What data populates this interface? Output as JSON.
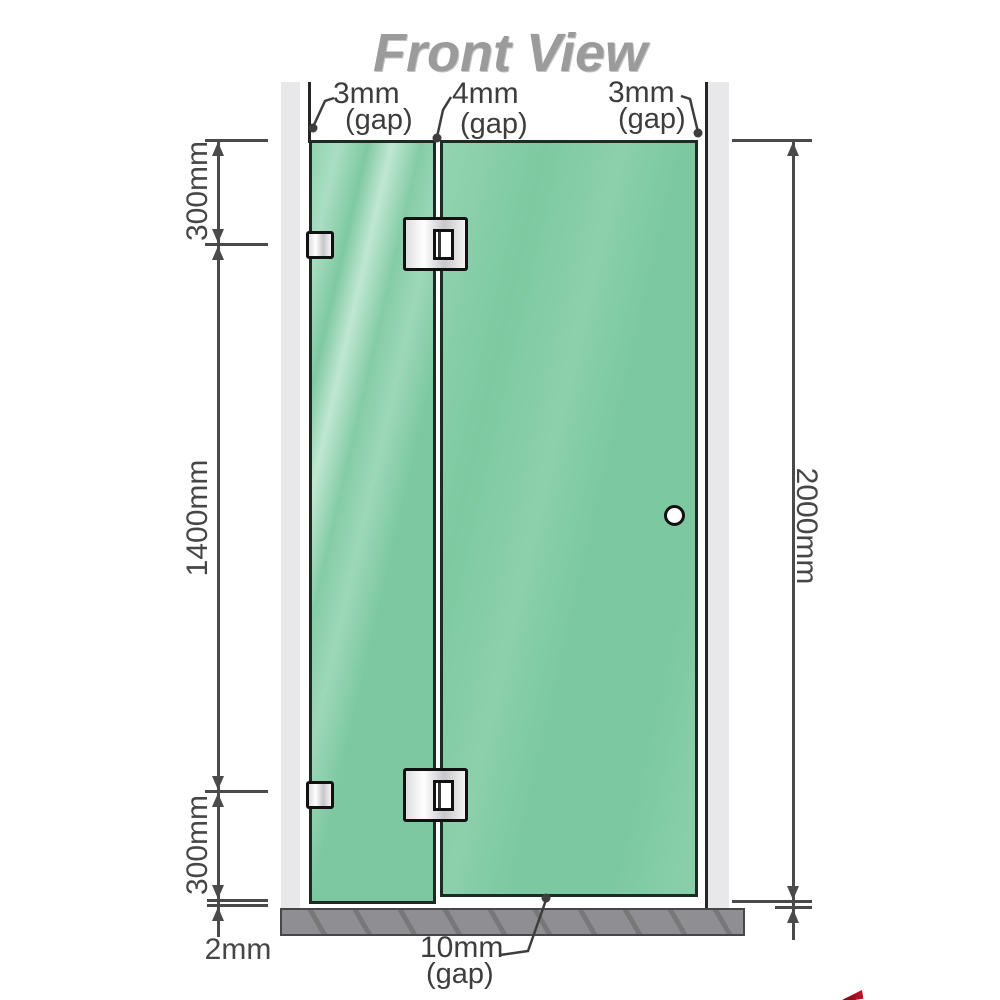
{
  "title": "Front View",
  "gaps": {
    "top_left": {
      "value": "3mm",
      "note": "(gap)"
    },
    "top_middle": {
      "value": "4mm",
      "note": "(gap)"
    },
    "top_right": {
      "value": "3mm",
      "note": "(gap)"
    },
    "bottom": {
      "value": "10mm",
      "note": "(gap)"
    }
  },
  "dims": {
    "left_top": "300mm",
    "left_middle": "1400mm",
    "left_bottom": "300mm",
    "right_height": "2000mm",
    "base_gap": "2mm"
  },
  "colors": {
    "glass": "#7ec9a2",
    "glass_border": "#1d2b23",
    "wall": "#e8e8ea",
    "base": "#8f8f93",
    "dimension_line": "#4a4a4a",
    "label_text": "#3d3d3d",
    "title_gray": "#9b9b9b",
    "hinge_border": "#111111",
    "logo_red": "#c01328"
  }
}
